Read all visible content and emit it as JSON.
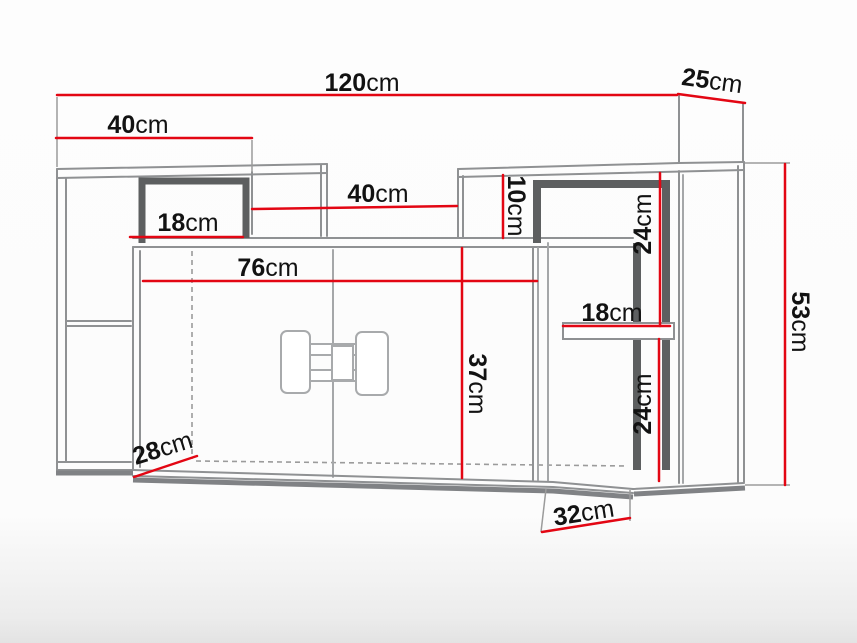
{
  "diagram": {
    "kind": "furniture-technical-drawing",
    "unit": "cm",
    "colors": {
      "dimension_line": "#e30613",
      "outline": "#8f9193",
      "outline_thick": "#5d5f60",
      "hidden_line": "#9b9b9b",
      "label_text": "#121212"
    },
    "dimensions": {
      "total_width": {
        "value": "120",
        "unit": "cm"
      },
      "top_depth": {
        "value": "25",
        "unit": "cm"
      },
      "left_shelf_width": {
        "value": "40",
        "unit": "cm"
      },
      "middle_gap_width": {
        "value": "40",
        "unit": "cm"
      },
      "left_niche_width": {
        "value": "18",
        "unit": "cm"
      },
      "cabinet_inner_width": {
        "value": "76",
        "unit": "cm"
      },
      "cabinet_inner_height": {
        "value": "37",
        "unit": "cm"
      },
      "right_gap_height": {
        "value": "10",
        "unit": "cm"
      },
      "right_upper_niche_height": {
        "value": "24",
        "unit": "cm"
      },
      "right_shelf_width": {
        "value": "18",
        "unit": "cm"
      },
      "right_lower_niche_height": {
        "value": "24",
        "unit": "cm"
      },
      "total_height": {
        "value": "53",
        "unit": "cm"
      },
      "cabinet_depth": {
        "value": "28",
        "unit": "cm"
      },
      "bottom_depth": {
        "value": "32",
        "unit": "cm"
      }
    }
  }
}
